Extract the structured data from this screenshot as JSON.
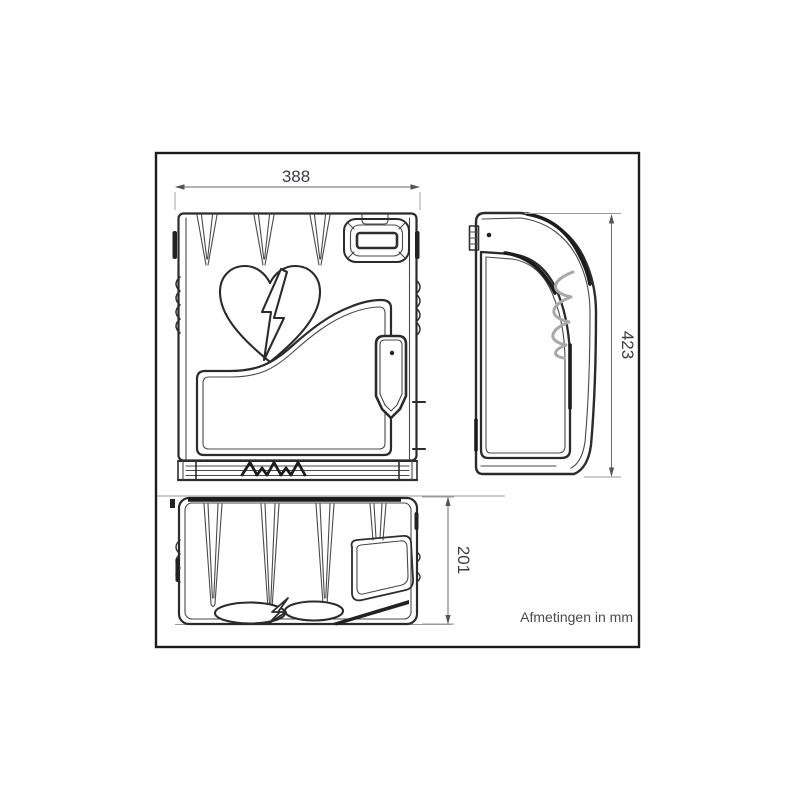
{
  "drawing": {
    "dimensions": {
      "width": "388",
      "height": "423",
      "depth": "201"
    },
    "note": "Afmetingen in mm",
    "icons": {
      "front_logo": "broken-heart-lightning-icon",
      "brand_mark": "zigzag-brand-mark"
    },
    "colors": {
      "line": "#2b2b2b",
      "dimension_line": "#6a6a6a",
      "label_text": "#3d3d44",
      "background": "#ffffff"
    }
  }
}
